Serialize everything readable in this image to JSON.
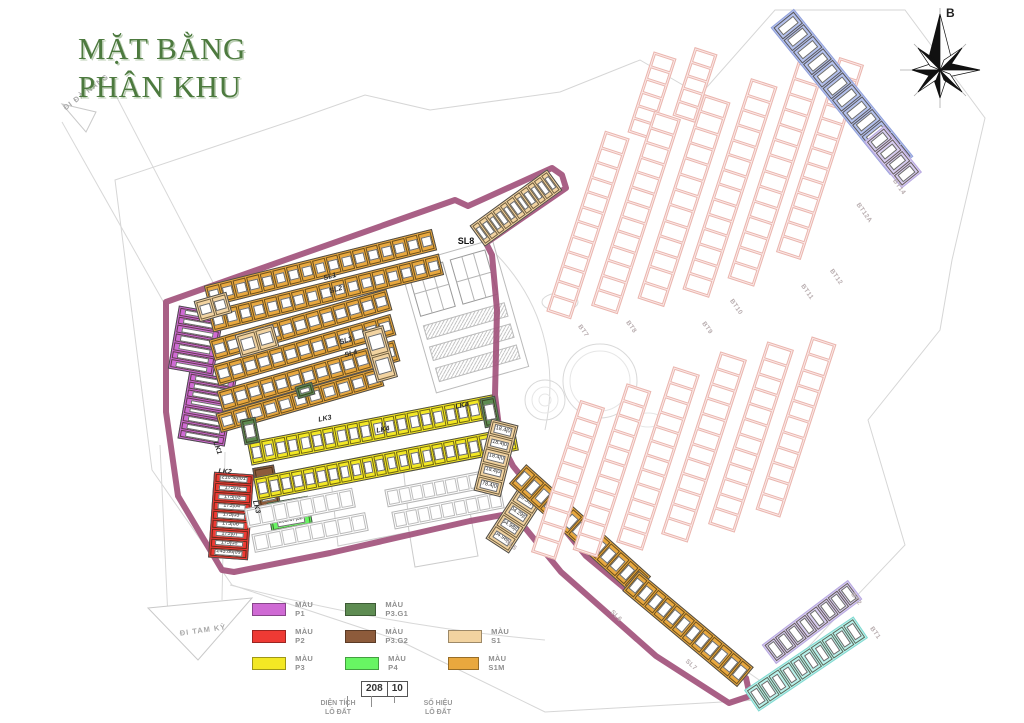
{
  "title": {
    "line1": "MẶT BẰNG",
    "line2": "PHÂN KHU",
    "color": "#4d7a3f"
  },
  "compass": {
    "north_label": "B"
  },
  "colors": {
    "boundary": "#a2527c",
    "P1": "#cf6ad4",
    "P2": "#ee3a34",
    "P3": "#f3e824",
    "P3G1": "#5e8c52",
    "P3G2": "#8d5b3b",
    "P4": "#68f563",
    "S1": "#f2d3a0",
    "S1M": "#e9a83e",
    "pinkFill": "#fbe9e7",
    "pinkStroke": "#eab5ae",
    "blueFill": "#b4c1ee",
    "blueStroke": "#93a2db",
    "lavFill": "#d8cdf1",
    "lavStroke": "#b8a9e0",
    "cyanFill": "#b9f2ec",
    "cyanStroke": "#83d8d0",
    "line": "#cfcfcf"
  },
  "legend": {
    "columns": [
      {
        "x": 252,
        "startRow": 0,
        "items": [
          {
            "label": "MÀU P1",
            "color": "#cf6ad4"
          },
          {
            "label": "MÀU P2",
            "color": "#ee3a34"
          },
          {
            "label": "MÀU P3",
            "color": "#f3e824"
          }
        ]
      },
      {
        "x": 345,
        "startRow": 0,
        "items": [
          {
            "label": "MÀU P3.G1",
            "color": "#5e8c52"
          },
          {
            "label": "MÀU P3.G2",
            "color": "#8d5b3b"
          },
          {
            "label": "MÀU P4",
            "color": "#68f563"
          }
        ]
      },
      {
        "x": 448,
        "startRow": 1,
        "items": [
          {
            "label": "MÀU S1",
            "color": "#f2d3a0"
          },
          {
            "label": "MÀU S1M",
            "color": "#e9a83e"
          }
        ]
      }
    ],
    "example": {
      "area": "208",
      "number": "10",
      "area_label1": "DIỆN TÍCH",
      "area_label2": "LÔ ĐẤT",
      "number_label1": "SỐ HIỆU",
      "number_label2": "LÔ ĐẤT"
    }
  },
  "map": {
    "strips": [
      {
        "name": "block-p1-upper",
        "x": 196,
        "y": 341,
        "w": 46,
        "h": 64,
        "r": 10,
        "dir": "col",
        "fill": "P1",
        "count": 7
      },
      {
        "name": "block-p1-lower",
        "x": 207,
        "y": 409,
        "w": 48,
        "h": 68,
        "r": 10,
        "dir": "col",
        "fill": "P1",
        "count": 8
      },
      {
        "name": "block-lk2-red",
        "x": 231,
        "y": 516,
        "w": 40,
        "h": 86,
        "r": 4,
        "dir": "col",
        "fill": "P2",
        "lots": [
          "216.98|01",
          "175|02",
          "175|03",
          "175|04",
          "175|05",
          "175|06",
          "175|07",
          "175|08",
          "243.86|09"
        ]
      },
      {
        "name": "block-p3g2-brown",
        "x": 267,
        "y": 489,
        "w": 22,
        "h": 46,
        "r": -10,
        "dir": "col",
        "fill": "P3G2",
        "lots": [
          "230.22|01"
        ]
      },
      {
        "name": "block-p4-green",
        "x": 291,
        "y": 521,
        "w": 42,
        "h": 44,
        "r": -10,
        "dir": "col",
        "fill": "P4",
        "lots": [
          "94.47|01",
          "203.87|02",
          "203.98|03"
        ]
      },
      {
        "name": "row-sl1",
        "x": 320,
        "y": 268,
        "w": 235,
        "h": 22,
        "r": -14,
        "fill": "S1M",
        "count": 17
      },
      {
        "name": "row-sl2",
        "x": 326,
        "y": 293,
        "w": 238,
        "h": 22,
        "r": -14,
        "fill": "S1M",
        "count": 17
      },
      {
        "name": "row-sl3",
        "x": 300,
        "y": 325,
        "w": 185,
        "h": 22,
        "r": -16,
        "fill": "S1M",
        "count": 13
      },
      {
        "name": "row-sl3b",
        "x": 304,
        "y": 350,
        "w": 185,
        "h": 22,
        "r": -16,
        "fill": "S1M",
        "count": 13
      },
      {
        "name": "row-sl4",
        "x": 308,
        "y": 376,
        "w": 185,
        "h": 22,
        "r": -16,
        "fill": "S1M",
        "count": 13
      },
      {
        "name": "row-sl4b",
        "x": 300,
        "y": 400,
        "w": 170,
        "h": 20,
        "r": -16,
        "fill": "S1M",
        "count": 11
      },
      {
        "name": "head-s1-a",
        "x": 213,
        "y": 307,
        "w": 34,
        "h": 22,
        "r": -16,
        "fill": "S1",
        "count": 2
      },
      {
        "name": "head-s1-b",
        "x": 257,
        "y": 341,
        "w": 40,
        "h": 24,
        "r": -16,
        "fill": "S1",
        "count": 2
      },
      {
        "name": "head-s1-c",
        "x": 380,
        "y": 354,
        "w": 22,
        "h": 54,
        "r": -16,
        "dir": "col",
        "fill": "S1",
        "count": 2
      },
      {
        "name": "row-lk3-yellow",
        "x": 372,
        "y": 430,
        "w": 250,
        "h": 24,
        "r": -11,
        "fill": "P3",
        "count": 20
      },
      {
        "name": "row-lk4-yellow",
        "x": 386,
        "y": 464,
        "w": 266,
        "h": 24,
        "r": -11,
        "fill": "P3",
        "count": 22
      },
      {
        "name": "block-p3g1-a",
        "x": 250,
        "y": 431,
        "w": 16,
        "h": 26,
        "r": -11,
        "dir": "col",
        "fill": "P3G1",
        "count": 1
      },
      {
        "name": "block-p3g1-b",
        "x": 490,
        "y": 412,
        "w": 16,
        "h": 30,
        "r": -11,
        "dir": "col",
        "fill": "P3G1",
        "count": 1
      },
      {
        "name": "block-p3g1-c",
        "x": 305,
        "y": 390,
        "w": 18,
        "h": 13,
        "r": -16,
        "fill": "P3G1",
        "count": 1
      },
      {
        "name": "row-white-a",
        "x": 300,
        "y": 508,
        "w": 110,
        "h": 20,
        "r": -11,
        "variant": "plain",
        "count": 8
      },
      {
        "name": "row-white-b",
        "x": 310,
        "y": 532,
        "w": 116,
        "h": 19,
        "r": -11,
        "variant": "plain",
        "count": 8
      },
      {
        "name": "row-white-c",
        "x": 440,
        "y": 488,
        "w": 110,
        "h": 18,
        "r": -11,
        "variant": "plain",
        "count": 9
      },
      {
        "name": "row-white-d",
        "x": 448,
        "y": 510,
        "w": 112,
        "h": 18,
        "r": -11,
        "variant": "plain",
        "count": 9
      },
      {
        "name": "col-s1-east-upper",
        "x": 496,
        "y": 458,
        "w": 28,
        "h": 74,
        "r": 14,
        "dir": "col",
        "fill": "S1",
        "lots": [
          "218.4|01",
          "218.4|02",
          "218.4|03",
          "218.4|04",
          "278.4|05"
        ]
      },
      {
        "name": "col-s1-east-lower",
        "x": 514,
        "y": 520,
        "w": 28,
        "h": 62,
        "r": 33,
        "dir": "col",
        "fill": "S1",
        "lots": [
          "239.33|06",
          "204.29|07",
          "254.98|08",
          "204.98|09"
        ]
      },
      {
        "name": "row-sl8",
        "x": 516,
        "y": 208,
        "w": 96,
        "h": 26,
        "r": -36,
        "fill": "S1",
        "count": 11
      },
      {
        "name": "arm-sl5",
        "x": 580,
        "y": 530,
        "w": 168,
        "h": 26,
        "r": 42,
        "fill": "S1M",
        "count": 13
      },
      {
        "name": "arm-sl6",
        "x": 688,
        "y": 629,
        "w": 150,
        "h": 26,
        "r": 40,
        "fill": "S1M",
        "count": 12
      },
      {
        "name": "bt-strip-top-a",
        "x": 652,
        "y": 95,
        "w": 24,
        "h": 85,
        "r": 18,
        "dir": "col",
        "variant": "faded",
        "count": 6
      },
      {
        "name": "bt-strip-top-b",
        "x": 695,
        "y": 85,
        "w": 24,
        "h": 72,
        "r": 18,
        "dir": "col",
        "variant": "faded",
        "count": 5
      },
      {
        "name": "bt7-strip",
        "x": 588,
        "y": 225,
        "w": 26,
        "h": 190,
        "r": 18,
        "dir": "col",
        "variant": "faded",
        "count": 12
      },
      {
        "name": "bt8-strip",
        "x": 636,
        "y": 212,
        "w": 28,
        "h": 205,
        "r": 18,
        "dir": "col",
        "variant": "faded",
        "count": 13
      },
      {
        "name": "bt9-strip",
        "x": 684,
        "y": 200,
        "w": 28,
        "h": 215,
        "r": 18,
        "dir": "col",
        "variant": "faded",
        "count": 13
      },
      {
        "name": "bt10-strip",
        "x": 730,
        "y": 188,
        "w": 28,
        "h": 222,
        "r": 18,
        "dir": "col",
        "variant": "faded",
        "count": 14
      },
      {
        "name": "bt11-strip",
        "x": 776,
        "y": 174,
        "w": 28,
        "h": 228,
        "r": 18,
        "dir": "col",
        "variant": "faded",
        "count": 14
      },
      {
        "name": "bt12-strip",
        "x": 820,
        "y": 158,
        "w": 26,
        "h": 205,
        "r": 18,
        "dir": "col",
        "variant": "faded",
        "count": 13
      },
      {
        "name": "bt12a-strip-blue",
        "x": 842,
        "y": 92,
        "w": 30,
        "h": 190,
        "r": -39,
        "dir": "col",
        "fill": "blueFill",
        "stroke": "blueStroke",
        "count": 12
      },
      {
        "name": "bt14-strip-lavender",
        "x": 893,
        "y": 157,
        "w": 26,
        "h": 60,
        "r": -39,
        "dir": "col",
        "fill": "lavFill",
        "stroke": "lavStroke",
        "count": 4
      },
      {
        "name": "bt-lower-1",
        "x": 568,
        "y": 480,
        "w": 26,
        "h": 160,
        "r": 18,
        "dir": "col",
        "variant": "faded",
        "count": 10
      },
      {
        "name": "bt-lower-2",
        "x": 612,
        "y": 470,
        "w": 26,
        "h": 175,
        "r": 18,
        "dir": "col",
        "variant": "faded",
        "count": 11
      },
      {
        "name": "bt-lower-3",
        "x": 658,
        "y": 458,
        "w": 28,
        "h": 185,
        "r": 18,
        "dir": "col",
        "variant": "faded",
        "count": 12
      },
      {
        "name": "bt-lower-4",
        "x": 704,
        "y": 447,
        "w": 28,
        "h": 192,
        "r": 18,
        "dir": "col",
        "variant": "faded",
        "count": 12
      },
      {
        "name": "bt-lower-5",
        "x": 751,
        "y": 437,
        "w": 28,
        "h": 192,
        "r": 18,
        "dir": "col",
        "variant": "faded",
        "count": 12
      },
      {
        "name": "bt-lower-6",
        "x": 796,
        "y": 427,
        "w": 26,
        "h": 182,
        "r": 18,
        "dir": "col",
        "variant": "faded",
        "count": 11
      },
      {
        "name": "bt2-strip-lavender",
        "x": 812,
        "y": 622,
        "w": 24,
        "h": 108,
        "r": 53,
        "dir": "col",
        "fill": "lavFill",
        "stroke": "lavStroke",
        "count": 8
      },
      {
        "name": "bt1-strip-cyan",
        "x": 806,
        "y": 664,
        "w": 26,
        "h": 132,
        "r": 56,
        "dir": "col",
        "fill": "cyanFill",
        "stroke": "cyanStroke",
        "count": 10
      }
    ],
    "labels": [
      {
        "text": "SL8",
        "x": 466,
        "y": 241,
        "r": 0,
        "cls": "blk",
        "name": "label-sl8"
      },
      {
        "text": "SL1",
        "x": 330,
        "y": 277,
        "r": -15,
        "cls": "row",
        "name": "label-sl1"
      },
      {
        "text": "SL2",
        "x": 336,
        "y": 290,
        "r": -15,
        "cls": "row",
        "name": "label-sl2"
      },
      {
        "text": "SL3",
        "x": 346,
        "y": 341,
        "r": -16,
        "cls": "row",
        "name": "label-sl3"
      },
      {
        "text": "SL4",
        "x": 351,
        "y": 354,
        "r": -16,
        "cls": "row",
        "name": "label-sl4"
      },
      {
        "text": "LK1",
        "x": 217,
        "y": 448,
        "r": 70,
        "cls": "row",
        "name": "label-lk1"
      },
      {
        "text": "LK2",
        "x": 225,
        "y": 472,
        "r": 4,
        "cls": "row",
        "name": "label-lk2"
      },
      {
        "text": "LK3",
        "x": 325,
        "y": 419,
        "r": -11,
        "cls": "row",
        "name": "label-lk3"
      },
      {
        "text": "LK3",
        "x": 256,
        "y": 507,
        "r": 75,
        "cls": "row",
        "name": "label-lk3-b"
      },
      {
        "text": "LK4",
        "x": 383,
        "y": 430,
        "r": -11,
        "cls": "row",
        "name": "label-lk4"
      },
      {
        "text": "LK4",
        "x": 462,
        "y": 406,
        "r": -11,
        "cls": "row",
        "name": "label-lk4-b"
      },
      {
        "text": "SL5",
        "x": 511,
        "y": 545,
        "r": 45,
        "cls": "gray",
        "name": "label-sl5"
      },
      {
        "text": "SL6",
        "x": 616,
        "y": 616,
        "r": 45,
        "cls": "gray",
        "name": "label-sl6"
      },
      {
        "text": "SL7",
        "x": 691,
        "y": 665,
        "r": 42,
        "cls": "gray",
        "name": "label-sl7"
      },
      {
        "text": "BT7",
        "x": 583,
        "y": 331,
        "r": 55,
        "cls": "gray",
        "name": "label-bt7"
      },
      {
        "text": "BT8",
        "x": 631,
        "y": 327,
        "r": 55,
        "cls": "gray",
        "name": "label-bt8"
      },
      {
        "text": "BT9",
        "x": 707,
        "y": 328,
        "r": 55,
        "cls": "gray",
        "name": "label-bt9"
      },
      {
        "text": "BT10",
        "x": 736,
        "y": 307,
        "r": 55,
        "cls": "gray",
        "name": "label-bt10"
      },
      {
        "text": "BT11",
        "x": 807,
        "y": 292,
        "r": 55,
        "cls": "gray",
        "name": "label-bt11"
      },
      {
        "text": "BT12",
        "x": 836,
        "y": 277,
        "r": 55,
        "cls": "gray",
        "name": "label-bt12"
      },
      {
        "text": "BT12A",
        "x": 864,
        "y": 213,
        "r": 55,
        "cls": "gray",
        "name": "label-bt12a"
      },
      {
        "text": "BT14",
        "x": 899,
        "y": 187,
        "r": 55,
        "cls": "gray",
        "name": "label-bt14"
      },
      {
        "text": "BT2",
        "x": 856,
        "y": 599,
        "r": 55,
        "cls": "gray",
        "name": "label-bt2"
      },
      {
        "text": "BT1",
        "x": 875,
        "y": 633,
        "r": 55,
        "cls": "gray",
        "name": "label-bt1"
      },
      {
        "text": "ĐI ĐÀ NẴNG",
        "x": 86,
        "y": 92,
        "r": -37,
        "cls": "road",
        "name": "label-road-da-nang"
      },
      {
        "text": "ĐI TAM KỲ",
        "x": 203,
        "y": 630,
        "r": -8,
        "cls": "road",
        "name": "label-road-tam-ky"
      }
    ]
  }
}
